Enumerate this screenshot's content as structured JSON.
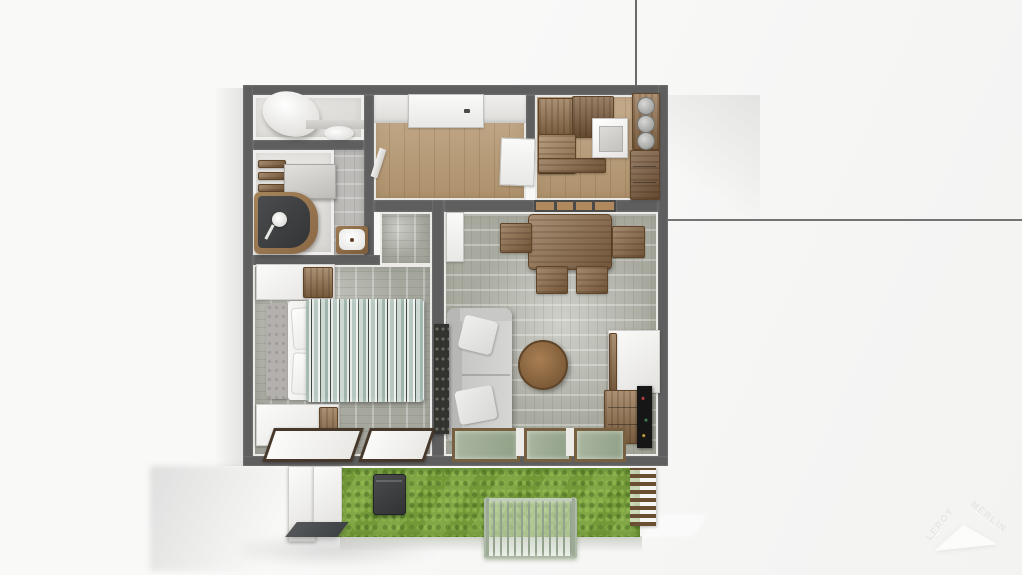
{
  "watermark": {
    "brand_line1": "LEROY",
    "brand_line2": "MERLIN"
  },
  "colors": {
    "background": "#f6f6f5",
    "wall": "#5e5e5e",
    "wood_floor": "#b89a73",
    "distressed_floor": "#a6a89e",
    "bathroom_tiles": "#bcbbb8",
    "grass": "#7aa23c",
    "sofa_gray": "#cfcfcd",
    "wood_furniture": "#8a6845",
    "duvet_teal": "#a3bab2",
    "shower_dark": "#3e4042",
    "tv_black": "#161616",
    "bin_dark": "#3c3e40"
  },
  "scene": {
    "type": "3d-floor-plan-top-view",
    "rooms": [
      "wc",
      "bathroom",
      "hallway",
      "kitchen",
      "bedroom",
      "living-room",
      "garden"
    ],
    "furniture": {
      "wc": [
        "toilet",
        "bidet",
        "ledge"
      ],
      "bathroom": [
        "wall-shelves",
        "washing-machine",
        "corner-shower",
        "sink"
      ],
      "hallway": [
        "entrance-door",
        "open-door-leaf",
        "radiator"
      ],
      "kitchen": [
        "upper-cabinets",
        "counter",
        "sink-unit",
        "canisters",
        "tall-cabinet"
      ],
      "bedroom": [
        "dresser",
        "headboard",
        "double-bed",
        "pillows",
        "duvet",
        "lowboard",
        "bay-windows"
      ],
      "living-room": [
        "dining-table",
        "four-chairs",
        "sofa",
        "cushions",
        "round-coffee-table",
        "wall-panel",
        "white-cabinet",
        "wood-dresser",
        "tv",
        "glazed-doors",
        "pass-through-window"
      ],
      "garden": [
        "lawn",
        "storage-bin",
        "glass-balustrade",
        "slatted-fence",
        "exterior-wall"
      ]
    }
  }
}
